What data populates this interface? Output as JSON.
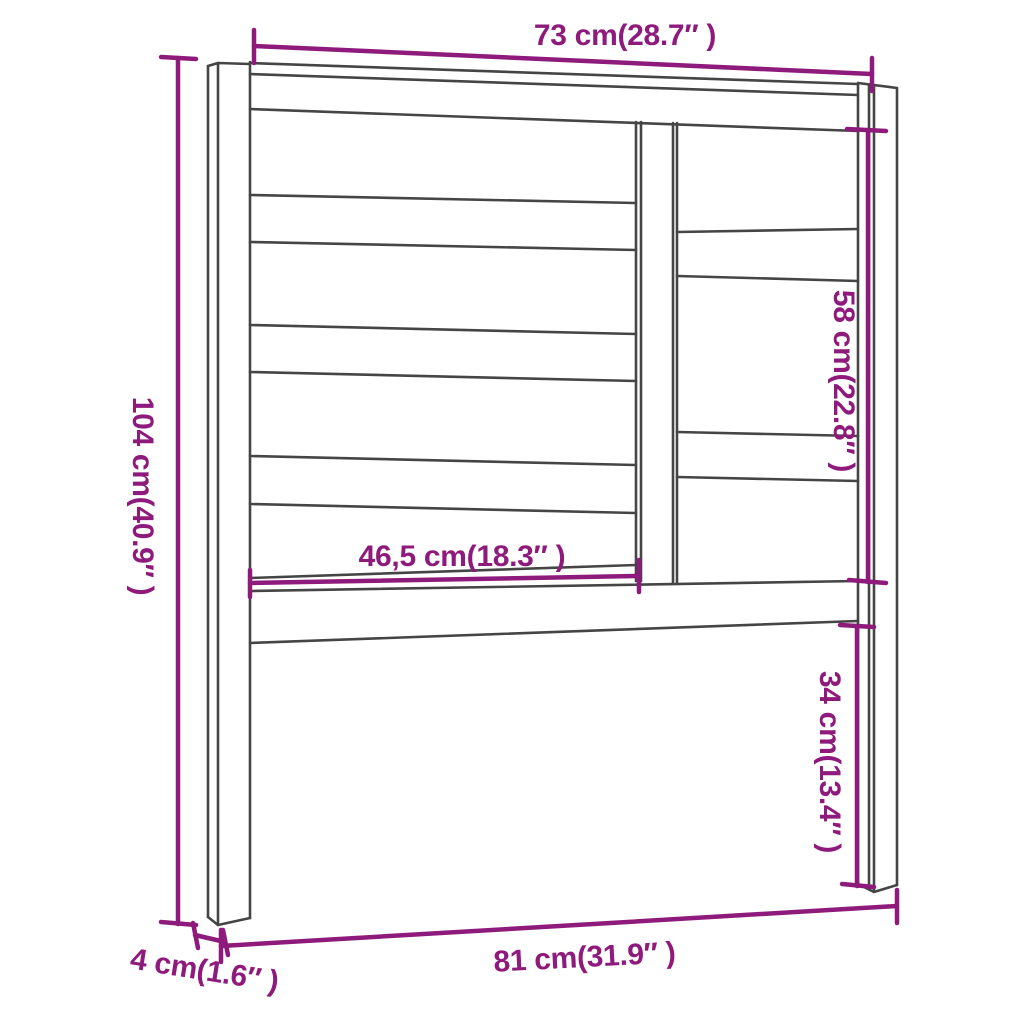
{
  "colors": {
    "background": "#FFFFFF",
    "outline": "#454545",
    "dimension_accent": "#8E1B7C"
  },
  "dimensions": {
    "top_width": {
      "label": "73 cm(28.7″ )"
    },
    "left_height": {
      "label": "104 cm(40.9″ )"
    },
    "inner_width": {
      "label": "46,5 cm(18.3″ )"
    },
    "right_upper_height": {
      "label": "58 cm(22.8″ )"
    },
    "right_lower_height": {
      "label": "34 cm(13.4″ )"
    },
    "bottom_width": {
      "label": "81 cm(31.9″ )"
    },
    "leg_depth": {
      "label": "4 cm(1.6″ )"
    }
  }
}
